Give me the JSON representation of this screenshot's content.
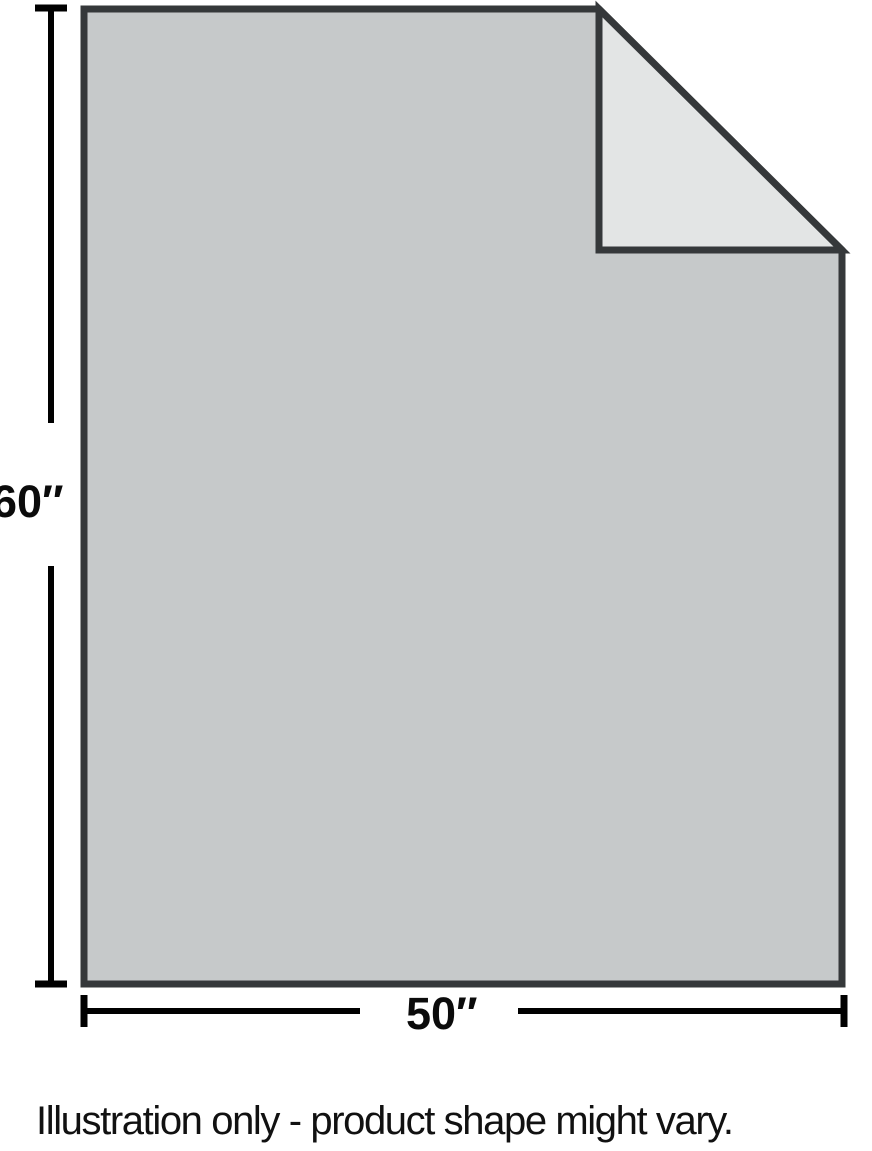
{
  "illustration": {
    "height_label": "60″",
    "width_label": "50″",
    "caption": "Illustration only - product shape might vary.",
    "colors": {
      "body_fill": "#c6c9ca",
      "fold_fill": "#e3e5e5",
      "outline": "#35383a",
      "dimension_lines": "#000000"
    }
  }
}
